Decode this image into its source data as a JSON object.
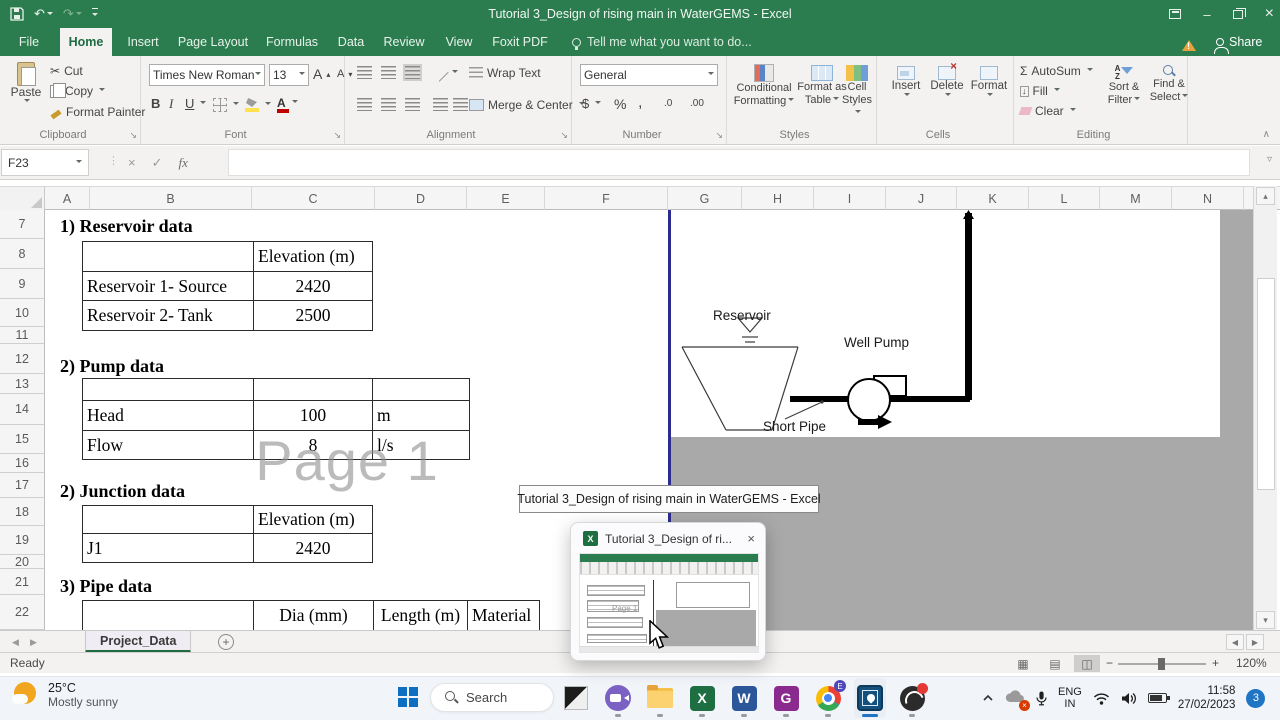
{
  "window": {
    "title": "Tutorial 3_Design of rising main in WaterGEMS - Excel",
    "share_label": "Share",
    "tell_me": "Tell me what you want to do..."
  },
  "ribbon_tabs": [
    "File",
    "Home",
    "Insert",
    "Page Layout",
    "Formulas",
    "Data",
    "Review",
    "View",
    "Foxit PDF"
  ],
  "ribbon": {
    "paste": "Paste",
    "cut": "Cut",
    "copy": "Copy",
    "format_painter": "Format Painter",
    "clipboard_label": "Clipboard",
    "font_name": "Times New Roman",
    "font_size": "13",
    "font_label": "Font",
    "bold": "B",
    "italic": "I",
    "underline": "U",
    "grow_font": "A",
    "shrink_font": "A",
    "font_color_letter": "A",
    "wrap_text": "Wrap Text",
    "merge_center": "Merge & Center",
    "alignment_label": "Alignment",
    "number_format": "General",
    "currency": "$",
    "percent": "%",
    "comma": ",",
    "inc_dec": ".00",
    "dec_dec": ".0",
    "number_label": "Number",
    "conditional_1": "Conditional",
    "conditional_2": "Formatting",
    "format_table_1": "Format as",
    "format_table_2": "Table",
    "cell_styles_1": "Cell",
    "cell_styles_2": "Styles",
    "styles_label": "Styles",
    "insert": "Insert",
    "delete": "Delete",
    "format": "Format",
    "cells_label": "Cells",
    "autosum": "AutoSum",
    "fill": "Fill",
    "clear": "Clear",
    "sort_1": "Sort &",
    "sort_2": "Filter",
    "find_1": "Find &",
    "find_2": "Select",
    "editing_label": "Editing"
  },
  "formula_bar": {
    "name_box": "F23",
    "fx": "fx",
    "formula": ""
  },
  "grid": {
    "columns": [
      "A",
      "B",
      "C",
      "D",
      "E",
      "F",
      "G",
      "H",
      "I",
      "J",
      "K",
      "L",
      "M",
      "N"
    ],
    "rows": [
      "7",
      "8",
      "9",
      "10",
      "11",
      "12",
      "13",
      "14",
      "15",
      "16",
      "17",
      "18",
      "19",
      "20",
      "21",
      "22"
    ],
    "watermark": "Page 1"
  },
  "sheet": {
    "reservoir_heading": "1) Reservoir data",
    "reservoir_table": {
      "col2_header": "Elevation (m)",
      "r1_label": "Reservoir 1- Source",
      "r1_value": "2420",
      "r2_label": "Reservoir 2- Tank",
      "r2_value": "2500"
    },
    "pump_heading": "2) Pump data",
    "pump_table": {
      "r1_label": "Head",
      "r1_value": "100",
      "r1_unit": "m",
      "r2_label": "Flow",
      "r2_value": "8",
      "r2_unit": "l/s"
    },
    "junction_heading": "2) Junction data",
    "junction_table": {
      "col2_header": "Elevation (m)",
      "r1_label": "J1",
      "r1_value": "2420"
    },
    "pipe_heading": "3) Pipe data",
    "pipe_table": {
      "col2_header": "Dia (mm)",
      "col3_header": "Length (m)",
      "col4_header": "Material"
    }
  },
  "diagram": {
    "reservoir": "Reservoir",
    "well_pump": "Well Pump",
    "short_pipe": "Short Pipe"
  },
  "tooltip": {
    "text": "Tutorial 3_Design of rising main in WaterGEMS - Excel"
  },
  "preview": {
    "title": "Tutorial 3_Design of ri...",
    "watermark": "Page 1"
  },
  "sheet_tabs": {
    "active": "Project_Data"
  },
  "status_bar": {
    "mode": "Ready",
    "zoom": "120%"
  },
  "taskbar": {
    "weather_temp": "25°C",
    "weather_condition": "Mostly sunny",
    "search_placeholder": "Search",
    "letters": {
      "excel": "X",
      "word": "W",
      "foxit": "G",
      "edge_badge": "E"
    },
    "tray": {
      "lang_line1": "ENG",
      "lang_line2": "IN",
      "time": "11:58",
      "date": "27/02/2023",
      "badge_count": "3"
    }
  },
  "glyphs": {
    "dropdown": "▾",
    "up_small": "▴",
    "left": "◀",
    "right": "▶",
    "close": "×",
    "check": "✓",
    "undo": "↶",
    "redo": "↷",
    "sum": "Σ",
    "cut": "✂",
    "launcher": "↘",
    "view_normal": "▦",
    "view_layout": "▤",
    "view_break": "◫",
    "minus": "−",
    "plus": "+",
    "warning": "!",
    "minimize": "–",
    "new_sheet": "+",
    "dots": "⋮",
    "chevron_up": "∧",
    "fill_arrow": "↓",
    "expand": "▿"
  }
}
